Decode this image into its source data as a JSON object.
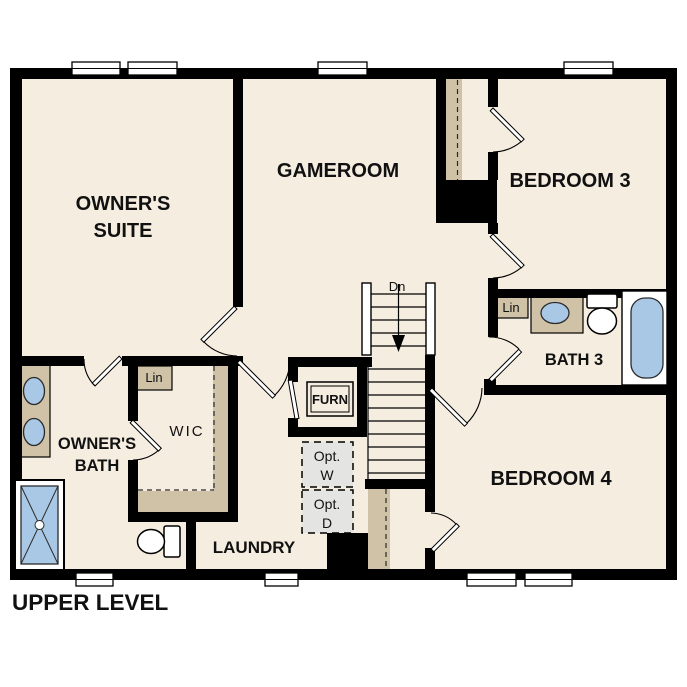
{
  "title": "UPPER LEVEL",
  "colors": {
    "paper": "#FFFFFF",
    "floor": "#F5EDE0",
    "wall": "#000000",
    "cabinetry": "#CFC2A6",
    "fixture": "#A9C8E6",
    "optional_fill": "#E4E4E2",
    "ink": "#111111"
  },
  "labels": {
    "owners_suite_1": "OWNER'S",
    "owners_suite_2": "SUITE",
    "gameroom": "GAMEROOM",
    "bedroom3": "BEDROOM 3",
    "bath3": "BATH 3",
    "bedroom4": "BEDROOM 4",
    "owners_bath_1": "OWNER'S",
    "owners_bath_2": "BATH",
    "wic": "WIC",
    "laundry": "LAUNDRY",
    "furnace": "FURN",
    "linen_wic": "Lin",
    "linen_bath3": "Lin",
    "stairs_down": "Dn",
    "opt_washer_1": "Opt.",
    "opt_washer_2": "W",
    "opt_dryer_1": "Opt.",
    "opt_dryer_2": "D"
  }
}
